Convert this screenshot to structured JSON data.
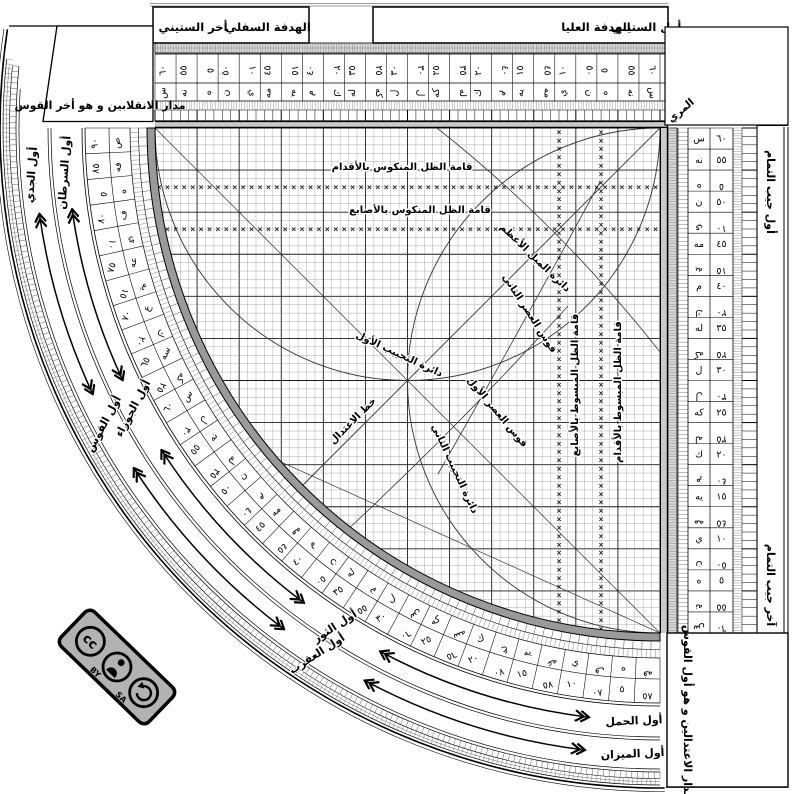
{
  "instrument": {
    "top_left_corner_label": "مدار الانقلابين و هو أخر القوس",
    "bottom_right_corner_label": "مدار الاعتدالين و هو أول القوس",
    "muri_label": "المري",
    "tab_labels": {
      "sixty_end": "أخر الستيني",
      "lower_sight": "الهدفة السفلي",
      "upper_sight": "الهدفة العليا",
      "sixty_start": "أول الستيني"
    },
    "cosine_scale": {
      "start_label": "أول جيب التمام",
      "end_label": "آخر جيب التمام"
    },
    "grid_labels": {
      "shadow_reversed_feet": "قامة الظل المنكوس بالأقدام",
      "shadow_reversed_digits": "قامة الظل المنكوس بالأصابع",
      "shadow_extended_digits": "قامة الظل المبسوط بالأصابع",
      "shadow_extended_feet": "قامة الظل المبسوط بالأقدام",
      "first_sine_circle": "دائرة التجييب الأول",
      "second_sine_circle": "دائرة التجييب الثاني",
      "max_declination_circle": "دائرة الميل الأعظم",
      "first_asr_arc": "قوس العصر الأول",
      "second_asr_arc": "قوس العصر الثاني",
      "equinox_line": "خط الاعتدال"
    }
  },
  "zodiac": {
    "inner_band": [
      {
        "label": "أول الحمل",
        "arc_deg": 0
      },
      {
        "label": "أول الثور",
        "arc_deg": 30
      },
      {
        "label": "أول الجوزاء",
        "arc_deg": 60
      },
      {
        "label": "أول السرطان",
        "arc_deg": 90
      }
    ],
    "outer_band": [
      {
        "label": "أول الميزان",
        "arc_deg": 0
      },
      {
        "label": "أول العقرب",
        "arc_deg": 30
      },
      {
        "label": "أول القوس",
        "arc_deg": 60
      },
      {
        "label": "أول الجدي",
        "arc_deg": 90
      }
    ]
  },
  "scales": {
    "sexagesimal_cells": [
      {
        "num": "٦٠",
        "abjad": "س",
        "flip": false
      },
      {
        "num": "٥٥",
        "abjad": "نه",
        "flip": false
      },
      {
        "num": "٥",
        "abjad": "ه",
        "flip": true
      },
      {
        "num": "٥٠",
        "abjad": "ن",
        "flip": false
      },
      {
        "num": "١٠",
        "abjad": "ي",
        "flip": true
      },
      {
        "num": "٤٥",
        "abjad": "مه",
        "flip": false
      },
      {
        "num": "١٥",
        "abjad": "يه",
        "flip": true
      },
      {
        "num": "٤٠",
        "abjad": "م",
        "flip": false
      },
      {
        "num": "٢٠",
        "abjad": "ك",
        "flip": true
      },
      {
        "num": "٣٥",
        "abjad": "له",
        "flip": false
      },
      {
        "num": "٢٥",
        "abjad": "كه",
        "flip": true
      },
      {
        "num": "٣٠",
        "abjad": "ل",
        "flip": false
      },
      {
        "num": "٣٠",
        "abjad": "ل",
        "flip": true
      },
      {
        "num": "٢٥",
        "abjad": "كه",
        "flip": false
      },
      {
        "num": "٣٥",
        "abjad": "له",
        "flip": true
      },
      {
        "num": "٢٠",
        "abjad": "ك",
        "flip": false
      },
      {
        "num": "٤٠",
        "abjad": "م",
        "flip": true
      },
      {
        "num": "١٥",
        "abjad": "يه",
        "flip": false
      },
      {
        "num": "٤٥",
        "abjad": "مه",
        "flip": true
      },
      {
        "num": "١٠",
        "abjad": "ي",
        "flip": false
      },
      {
        "num": "٥٠",
        "abjad": "ن",
        "flip": true
      },
      {
        "num": "٥",
        "abjad": "ه",
        "flip": false
      },
      {
        "num": "٥٥",
        "abjad": "نه",
        "flip": true
      },
      {
        "num": "٦٠",
        "abjad": "س",
        "flip": true
      }
    ],
    "arc_degree_cells": [
      {
        "num": "٩٠",
        "abjad": "ص",
        "flip": false
      },
      {
        "num": "٨٥",
        "abjad": "فه",
        "flip": false
      },
      {
        "num": "٥",
        "abjad": "ه",
        "flip": true
      },
      {
        "num": "٨٠",
        "abjad": "ف",
        "flip": false
      },
      {
        "num": "١٠",
        "abjad": "ي",
        "flip": true
      },
      {
        "num": "٧٥",
        "abjad": "عه",
        "flip": false
      },
      {
        "num": "١٥",
        "abjad": "يه",
        "flip": true
      },
      {
        "num": "٧٠",
        "abjad": "ع",
        "flip": false
      },
      {
        "num": "٢٠",
        "abjad": "ك",
        "flip": true
      },
      {
        "num": "٦٥",
        "abjad": "سه",
        "flip": false
      },
      {
        "num": "٢٥",
        "abjad": "كه",
        "flip": true
      },
      {
        "num": "٦٠",
        "abjad": "س",
        "flip": false
      },
      {
        "num": "٣٠",
        "abjad": "ل",
        "flip": true
      },
      {
        "num": "٥٥",
        "abjad": "نه",
        "flip": false
      },
      {
        "num": "٣٥",
        "abjad": "له",
        "flip": true
      },
      {
        "num": "٥٠",
        "abjad": "ن",
        "flip": false
      },
      {
        "num": "٤٠",
        "abjad": "م",
        "flip": true
      },
      {
        "num": "٤٥",
        "abjad": "مه",
        "flip": false
      },
      {
        "num": "٤٥",
        "abjad": "مه",
        "flip": true
      },
      {
        "num": "٤٠",
        "abjad": "م",
        "flip": false
      },
      {
        "num": "٥٠",
        "abjad": "ن",
        "flip": true
      },
      {
        "num": "٣٥",
        "abjad": "له",
        "flip": false
      },
      {
        "num": "٥٥",
        "abjad": "نه",
        "flip": true
      },
      {
        "num": "٣٠",
        "abjad": "ل",
        "flip": false
      },
      {
        "num": "٦٠",
        "abjad": "س",
        "flip": true
      },
      {
        "num": "٢٥",
        "abjad": "كه",
        "flip": false
      },
      {
        "num": "٦٥",
        "abjad": "سه",
        "flip": true
      },
      {
        "num": "٢٠",
        "abjad": "ك",
        "flip": false
      },
      {
        "num": "٧٠",
        "abjad": "ع",
        "flip": true
      },
      {
        "num": "١٥",
        "abjad": "يه",
        "flip": false
      },
      {
        "num": "٧٥",
        "abjad": "عه",
        "flip": true
      },
      {
        "num": "١٠",
        "abjad": "ي",
        "flip": false
      },
      {
        "num": "٨٠",
        "abjad": "ف",
        "flip": true
      },
      {
        "num": "٥",
        "abjad": "ه",
        "flip": false
      },
      {
        "num": "٨٥",
        "abjad": "فه",
        "flip": true
      }
    ]
  },
  "license_badge": {
    "cc_label": "cc",
    "by_label": "BY",
    "sa_label": "SA"
  },
  "colors": {
    "ink": "#000000",
    "paper": "#ffffff",
    "band_grey": "#9a9a9a",
    "light_grey": "#d9d9d9",
    "grid_minor": "#8a8a8a",
    "grid_major": "#1c1c1c",
    "marker": "#222222"
  }
}
